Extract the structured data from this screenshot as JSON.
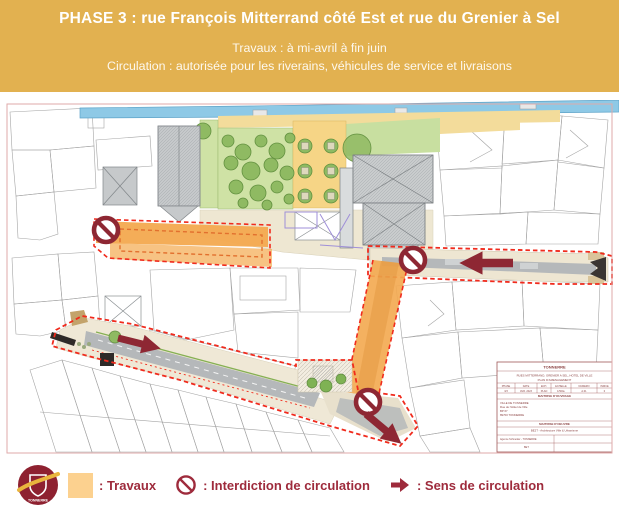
{
  "header": {
    "title": "PHASE 3 : rue François Mitterrand côté Est et rue du Grenier à Sel",
    "line1": "Travaux : à mi-avril à fin juin",
    "line2": "Circulation : autorisée pour les riverains, véhicules de service et livraisons"
  },
  "legend": {
    "logo_text": "TONNERRE",
    "items": [
      {
        "icon": "travaux-swatch-icon",
        "label": ": Travaux"
      },
      {
        "icon": "no-entry-icon",
        "label": ": Interdiction de circulation"
      },
      {
        "icon": "direction-arrow-icon",
        "label": ": Sens de circulation"
      }
    ]
  },
  "map": {
    "cartouche": {
      "commune": "TONNERRE",
      "project1": "RUES MITTERRAND, GRENIER A SEL, HOTEL DE VILLE",
      "project2": "PLAN D'AMENAGEMENT",
      "th": [
        "PHASE",
        "DATE",
        "ECH.",
        "ECHELLE",
        "NUMERO",
        "INDICE"
      ],
      "tv": [
        "3/3",
        "AVR. 2023",
        "PLAN",
        "1/500e",
        "A.01",
        "0"
      ],
      "moa_title": "MAITRISE D'OUVRAGE",
      "moa": [
        "VILLE DE TONNERRE",
        "Rue de l'Hôtel de Ville",
        "BP 67",
        "89700 TONNERRE"
      ],
      "moe_title": "MAITRISE D'OEUVRE",
      "moe1": "BE2T - Architecture Ville & Urbanisme",
      "moe2": "Agence Schneider - TONNERRE",
      "moe3": "BET"
    }
  },
  "colors": {
    "banner_bg": "#e2b150",
    "legend_text_red": "#9e2b3c",
    "sign_dark_red": "#8e2733",
    "zone_dash_red": "#f02b1d",
    "travaux_orange": "#f3a94f",
    "travaux_swatch": "#fcd18f",
    "river_blue": "#8ec9e6",
    "lawn_green": "#cfe2a5",
    "plaza_sand": "#f6d586"
  }
}
